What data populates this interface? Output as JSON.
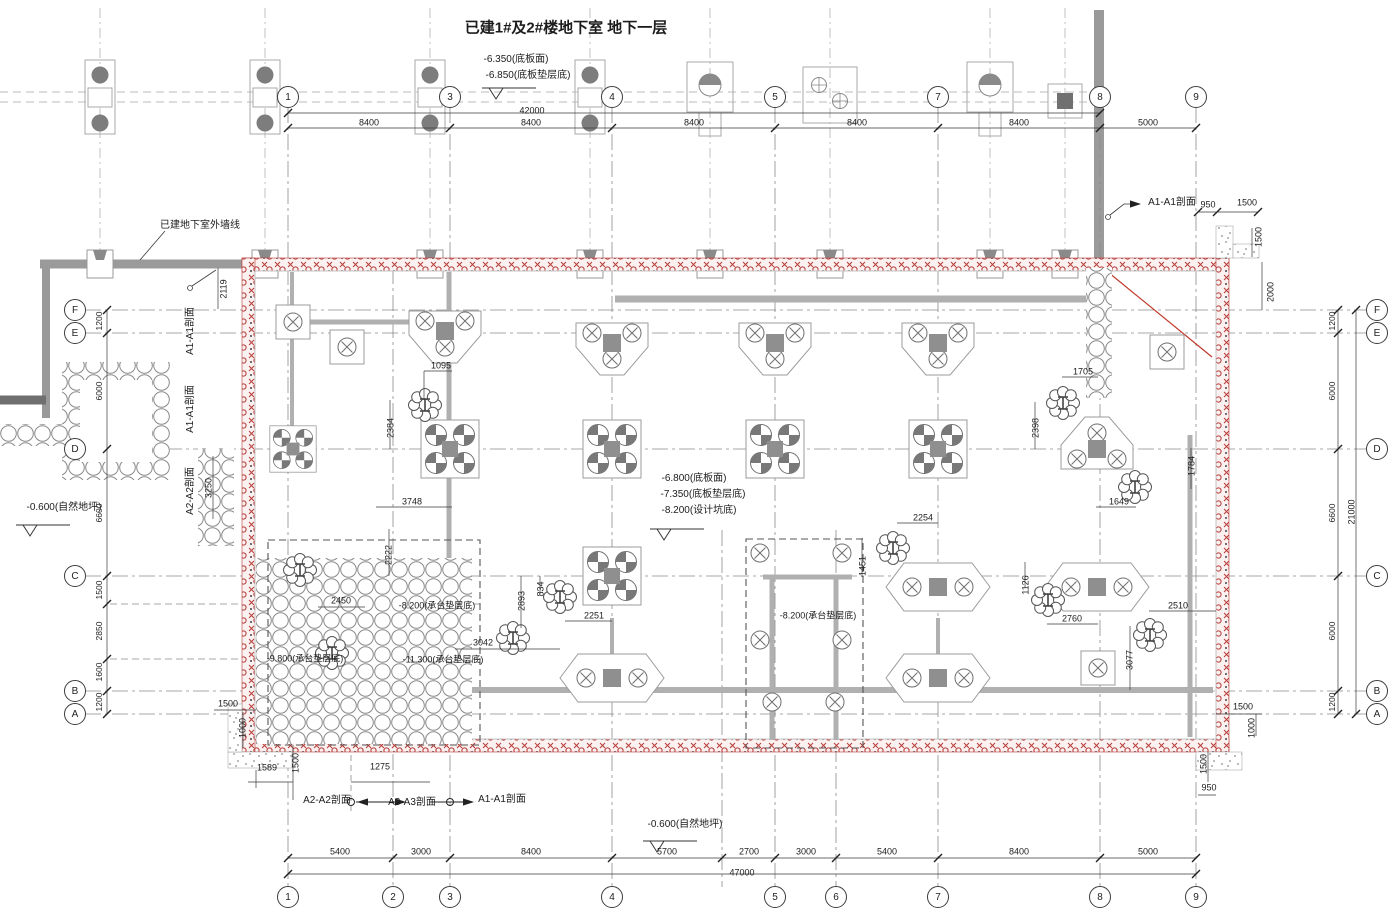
{
  "drawing": {
    "title": "已建1#及2#楼地下室 地下一层",
    "type_note": "基坑支护/承台桩位平面图"
  },
  "colors": {
    "pit_wall_red": "#b73a36",
    "existing_wall_grey": "#9a9a9a",
    "beam_grey": "#b0b0b0",
    "dim_line": "#3a3a3a",
    "red_diagonal": "#c0392b"
  },
  "grid_bubbles": {
    "top": [
      {
        "t": "1",
        "x": 288,
        "y": 97
      },
      {
        "t": "3",
        "x": 450,
        "y": 97
      },
      {
        "t": "4",
        "x": 612,
        "y": 97
      },
      {
        "t": "5",
        "x": 775,
        "y": 97
      },
      {
        "t": "7",
        "x": 938,
        "y": 97
      },
      {
        "t": "8",
        "x": 1100,
        "y": 97
      },
      {
        "t": "9",
        "x": 1196,
        "y": 97
      }
    ],
    "bottom": [
      {
        "t": "1",
        "x": 288,
        "y": 897
      },
      {
        "t": "2",
        "x": 393,
        "y": 897
      },
      {
        "t": "3",
        "x": 450,
        "y": 897
      },
      {
        "t": "4",
        "x": 612,
        "y": 897
      },
      {
        "t": "5",
        "x": 775,
        "y": 897
      },
      {
        "t": "6",
        "x": 836,
        "y": 897
      },
      {
        "t": "7",
        "x": 938,
        "y": 897
      },
      {
        "t": "8",
        "x": 1100,
        "y": 897
      },
      {
        "t": "9",
        "x": 1196,
        "y": 897
      }
    ],
    "left": [
      {
        "t": "F",
        "x": 75,
        "y": 310
      },
      {
        "t": "E",
        "x": 75,
        "y": 333
      },
      {
        "t": "D",
        "x": 75,
        "y": 449
      },
      {
        "t": "C",
        "x": 75,
        "y": 576
      },
      {
        "t": "B",
        "x": 75,
        "y": 691
      },
      {
        "t": "A",
        "x": 75,
        "y": 714
      }
    ],
    "right": [
      {
        "t": "F",
        "x": 1377,
        "y": 310
      },
      {
        "t": "E",
        "x": 1377,
        "y": 333
      },
      {
        "t": "D",
        "x": 1377,
        "y": 449
      },
      {
        "t": "C",
        "x": 1377,
        "y": 576
      },
      {
        "t": "B",
        "x": 1377,
        "y": 691
      },
      {
        "t": "A",
        "x": 1377,
        "y": 714
      }
    ]
  },
  "annotations": [
    {
      "n": "drawing-title",
      "t": "已建1#及2#楼地下室 地下一层",
      "x": 566,
      "y": 28,
      "s": 15,
      "b": 1
    },
    {
      "n": "level-note-slab-top",
      "t": "-6.350(底板面)",
      "x": 516,
      "y": 60,
      "s": 10
    },
    {
      "n": "level-note-slab-cushion",
      "t": "-6.850(底板垫层底)",
      "x": 528,
      "y": 76,
      "s": 10
    },
    {
      "n": "existing-basement-wall-note",
      "t": "已建地下室外墙线",
      "x": 200,
      "y": 226,
      "s": 10
    },
    {
      "n": "section-marker-a1a1-topright",
      "t": "A1-A1剖面",
      "x": 1172,
      "y": 203,
      "s": 10
    },
    {
      "n": "dim-topright-950",
      "t": "950",
      "x": 1208,
      "y": 205,
      "s": 9
    },
    {
      "n": "dim-topright-1500",
      "t": "1500",
      "x": 1247,
      "y": 203,
      "s": 9
    },
    {
      "n": "dim-right-1500-v",
      "t": "1500",
      "x": 1259,
      "y": 237,
      "s": 9,
      "r": -90
    },
    {
      "n": "dim-right-2000-v",
      "t": "2000",
      "x": 1271,
      "y": 292,
      "s": 9,
      "r": -90
    },
    {
      "n": "dim-2119",
      "t": "2119",
      "x": 224,
      "y": 289,
      "s": 9,
      "r": -90
    },
    {
      "n": "dim-top-total",
      "t": "42000",
      "x": 532,
      "y": 111,
      "s": 9
    },
    {
      "n": "dim-top-8400-1",
      "t": "8400",
      "x": 369,
      "y": 123,
      "s": 9
    },
    {
      "n": "dim-top-8400-2",
      "t": "8400",
      "x": 531,
      "y": 123,
      "s": 9
    },
    {
      "n": "dim-top-8400-3",
      "t": "8400",
      "x": 694,
      "y": 123,
      "s": 9
    },
    {
      "n": "dim-top-8400-4",
      "t": "8400",
      "x": 857,
      "y": 123,
      "s": 9
    },
    {
      "n": "dim-top-8400-5",
      "t": "8400",
      "x": 1019,
      "y": 123,
      "s": 9
    },
    {
      "n": "dim-top-5000",
      "t": "5000",
      "x": 1148,
      "y": 123,
      "s": 9
    },
    {
      "n": "section-a1a1-left-1",
      "t": "A1-A1剖面",
      "x": 191,
      "y": 331,
      "s": 10,
      "r": -90
    },
    {
      "n": "section-a1a1-left-2",
      "t": "A1-A1剖面",
      "x": 191,
      "y": 409,
      "s": 10,
      "r": -90
    },
    {
      "n": "section-a2a2-left",
      "t": "A2-A2剖面",
      "x": 191,
      "y": 491,
      "s": 10,
      "r": -90
    },
    {
      "n": "dim-3250",
      "t": "3250",
      "x": 209,
      "y": 488,
      "s": 9,
      "r": -90
    },
    {
      "n": "level-natural-ground-left",
      "t": "-0.600(自然地坪)",
      "x": 64,
      "y": 508,
      "s": 10
    },
    {
      "n": "dim-left-1200-fe",
      "t": "1200",
      "x": 99,
      "y": 321,
      "s": 8.5,
      "r": -90
    },
    {
      "n": "dim-left-6000-ed",
      "t": "6000",
      "x": 99,
      "y": 391,
      "s": 8.5,
      "r": -90
    },
    {
      "n": "dim-left-6600-dc",
      "t": "6600",
      "x": 99,
      "y": 513,
      "s": 8.5,
      "r": -90
    },
    {
      "n": "dim-left-1500",
      "t": "1500",
      "x": 99,
      "y": 590,
      "s": 8.5,
      "r": -90
    },
    {
      "n": "dim-left-2850",
      "t": "2850",
      "x": 99,
      "y": 631,
      "s": 8.5,
      "r": -90
    },
    {
      "n": "dim-left-1600",
      "t": "1600",
      "x": 99,
      "y": 672,
      "s": 8.5,
      "r": -90
    },
    {
      "n": "dim-left-1200-ba",
      "t": "1200",
      "x": 99,
      "y": 702,
      "s": 8.5,
      "r": -90
    },
    {
      "n": "dim-right-1200-fe",
      "t": "1200",
      "x": 1332,
      "y": 321,
      "s": 8.5,
      "r": -90
    },
    {
      "n": "dim-right-6000-ed",
      "t": "6000",
      "x": 1332,
      "y": 391,
      "s": 8.5,
      "r": -90
    },
    {
      "n": "dim-right-6600-dc",
      "t": "6600",
      "x": 1332,
      "y": 513,
      "s": 8.5,
      "r": -90
    },
    {
      "n": "dim-right-6000-cb",
      "t": "6000",
      "x": 1332,
      "y": 631,
      "s": 8.5,
      "r": -90
    },
    {
      "n": "dim-right-1200-ba",
      "t": "1200",
      "x": 1332,
      "y": 702,
      "s": 8.5,
      "r": -90
    },
    {
      "n": "dim-right-total",
      "t": "21000",
      "x": 1352,
      "y": 512,
      "s": 9,
      "r": -90
    },
    {
      "n": "level-pit-slab",
      "t": "-6.800(底板面)",
      "x": 694,
      "y": 479,
      "s": 10
    },
    {
      "n": "level-pit-cushion",
      "t": "-7.350(底板垫层底)",
      "x": 703,
      "y": 495,
      "s": 10
    },
    {
      "n": "level-pit-bottom",
      "t": "-8.200(设计坑底)",
      "x": 699,
      "y": 511,
      "s": 10
    },
    {
      "n": "level-natural-ground-bottom",
      "t": "-0.600(自然地坪)",
      "x": 685,
      "y": 825,
      "s": 10
    },
    {
      "n": "dim-1095",
      "t": "1095",
      "x": 441,
      "y": 366,
      "s": 9
    },
    {
      "n": "dim-2384",
      "t": "2384",
      "x": 391,
      "y": 428,
      "s": 9,
      "r": -90
    },
    {
      "n": "dim-3748",
      "t": "3748",
      "x": 412,
      "y": 502,
      "s": 9
    },
    {
      "n": "dim-2222",
      "t": "2222",
      "x": 389,
      "y": 555,
      "s": 9,
      "r": -90
    },
    {
      "n": "dim-2450",
      "t": "2450",
      "x": 341,
      "y": 601,
      "s": 9
    },
    {
      "n": "dim-2893",
      "t": "2893",
      "x": 522,
      "y": 601,
      "s": 9,
      "r": -90
    },
    {
      "n": "dim-834",
      "t": "834",
      "x": 541,
      "y": 589,
      "s": 9,
      "r": -90
    },
    {
      "n": "dim-2251",
      "t": "2251",
      "x": 594,
      "y": 616,
      "s": 9
    },
    {
      "n": "dim-3042",
      "t": "3042",
      "x": 483,
      "y": 643,
      "s": 9
    },
    {
      "n": "level-cap-cushion-1",
      "t": "-8.200(承台垫层底)",
      "x": 437,
      "y": 606,
      "s": 9
    },
    {
      "n": "level-cap-cushion-2",
      "t": "-9.800(承台垫层底)",
      "x": 305,
      "y": 659,
      "s": 9
    },
    {
      "n": "level-cap-cushion-3",
      "t": "-11.300(承台垫层底)",
      "x": 443,
      "y": 660,
      "s": 9
    },
    {
      "n": "level-cap-cushion-4",
      "t": "-8.200(承台垫层底)",
      "x": 818,
      "y": 616,
      "s": 9
    },
    {
      "n": "dim-2254",
      "t": "2254",
      "x": 923,
      "y": 518,
      "s": 9
    },
    {
      "n": "dim-1451",
      "t": "1451",
      "x": 863,
      "y": 566,
      "s": 9,
      "r": -90
    },
    {
      "n": "dim-1705",
      "t": "1705",
      "x": 1083,
      "y": 372,
      "s": 9
    },
    {
      "n": "dim-2398",
      "t": "2398",
      "x": 1036,
      "y": 428,
      "s": 9,
      "r": -90
    },
    {
      "n": "dim-1784",
      "t": "1784",
      "x": 1192,
      "y": 466,
      "s": 9,
      "r": -90
    },
    {
      "n": "dim-1649",
      "t": "1649",
      "x": 1119,
      "y": 502,
      "s": 9
    },
    {
      "n": "dim-1126",
      "t": "1126",
      "x": 1026,
      "y": 585,
      "s": 9,
      "r": -90
    },
    {
      "n": "dim-2760",
      "t": "2760",
      "x": 1072,
      "y": 619,
      "s": 9
    },
    {
      "n": "dim-2510",
      "t": "2510",
      "x": 1178,
      "y": 606,
      "s": 9
    },
    {
      "n": "dim-3077",
      "t": "3077",
      "x": 1130,
      "y": 660,
      "s": 9,
      "r": -90
    },
    {
      "n": "dim-bl-1500",
      "t": "1500",
      "x": 228,
      "y": 704,
      "s": 9
    },
    {
      "n": "dim-bl-1000",
      "t": "1000",
      "x": 243,
      "y": 728,
      "s": 9,
      "r": -90
    },
    {
      "n": "dim-1589",
      "t": "1589",
      "x": 267,
      "y": 768,
      "s": 9
    },
    {
      "n": "dim-bl-1500-v",
      "t": "1500",
      "x": 296,
      "y": 763,
      "s": 9,
      "r": -90
    },
    {
      "n": "dim-1275",
      "t": "1275",
      "x": 380,
      "y": 767,
      "s": 9
    },
    {
      "n": "section-a2a2-bottom",
      "t": "A2-A2剖面",
      "x": 327,
      "y": 801,
      "s": 10
    },
    {
      "n": "section-a3a3-bottom",
      "t": "A3-A3剖面",
      "x": 412,
      "y": 803,
      "s": 10
    },
    {
      "n": "section-a1a1-bottom",
      "t": "A1-A1剖面",
      "x": 502,
      "y": 800,
      "s": 10
    },
    {
      "n": "dim-br-1500",
      "t": "1500",
      "x": 1243,
      "y": 707,
      "s": 9
    },
    {
      "n": "dim-br-1000",
      "t": "1000",
      "x": 1252,
      "y": 728,
      "s": 9,
      "r": -90
    },
    {
      "n": "dim-br-1500-v",
      "t": "1500",
      "x": 1204,
      "y": 764,
      "s": 9,
      "r": -90
    },
    {
      "n": "dim-br-950",
      "t": "950",
      "x": 1209,
      "y": 788,
      "s": 9
    },
    {
      "n": "dim-bot-5400-1",
      "t": "5400",
      "x": 340,
      "y": 852,
      "s": 9
    },
    {
      "n": "dim-bot-3000-1",
      "t": "3000",
      "x": 421,
      "y": 852,
      "s": 9
    },
    {
      "n": "dim-bot-8400-1",
      "t": "8400",
      "x": 531,
      "y": 852,
      "s": 9
    },
    {
      "n": "dim-bot-5700",
      "t": "5700",
      "x": 667,
      "y": 852,
      "s": 9
    },
    {
      "n": "dim-bot-2700",
      "t": "2700",
      "x": 749,
      "y": 852,
      "s": 9
    },
    {
      "n": "dim-bot-3000-2",
      "t": "3000",
      "x": 806,
      "y": 852,
      "s": 9
    },
    {
      "n": "dim-bot-5400-2",
      "t": "5400",
      "x": 887,
      "y": 852,
      "s": 9
    },
    {
      "n": "dim-bot-8400-2",
      "t": "8400",
      "x": 1019,
      "y": 852,
      "s": 9
    },
    {
      "n": "dim-bot-5000",
      "t": "5000",
      "x": 1148,
      "y": 852,
      "s": 9
    },
    {
      "n": "dim-bot-total",
      "t": "47000",
      "x": 742,
      "y": 873,
      "s": 9
    }
  ]
}
